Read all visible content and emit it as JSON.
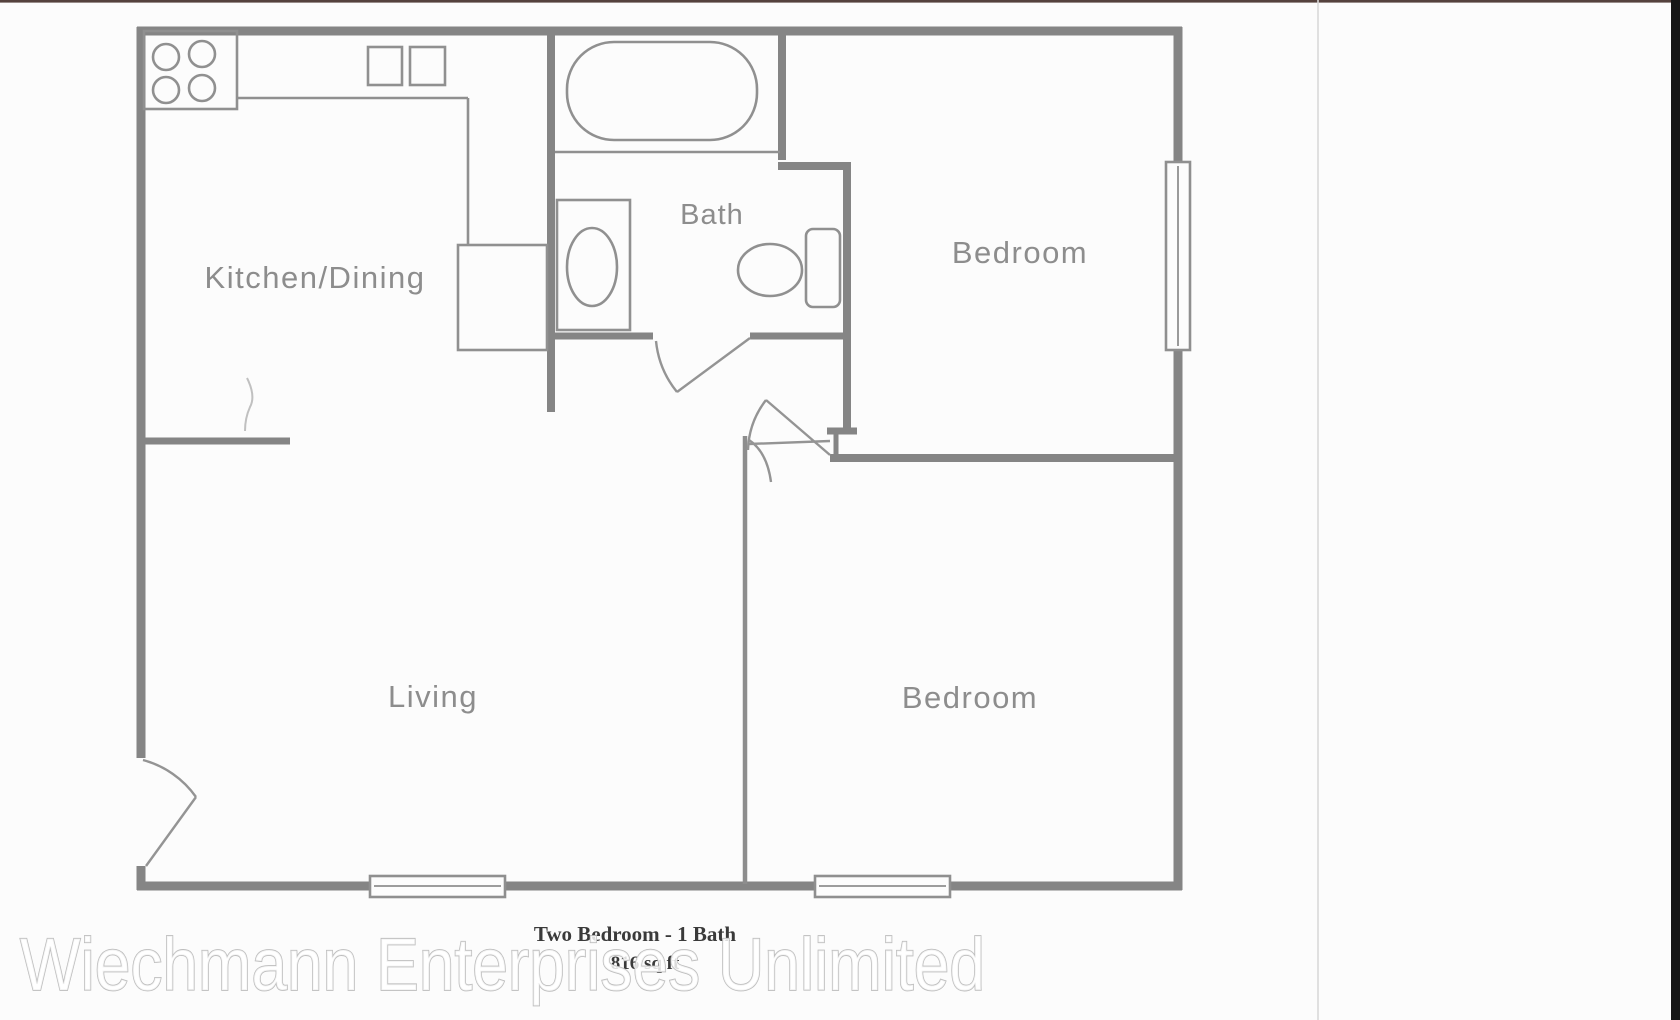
{
  "photo": {
    "caption_title": "Two Bedroom - 1 Bath",
    "caption_subtitle": "816 sq ft",
    "watermark": "Wiechmann Enterprises Unlimited"
  },
  "floor_plan": {
    "rooms": {
      "kitchen_dining": "Kitchen/Dining",
      "bath": "Bath",
      "bedroom_top": "Bedroom",
      "living": "Living",
      "bedroom_bottom": "Bedroom"
    },
    "colors": {
      "wall_line": "#858585",
      "fixture_line": "#909090",
      "door_line": "#949494",
      "room_label": "#8d8d8d",
      "caption_text": "#3a3a3a",
      "watermark_fill": "#ffffff",
      "watermark_outline": "#bdbdbd",
      "top_border": "#55423d",
      "right_edge_bar": "#171717",
      "scan_divider": "#d9d9d9",
      "paper": "#fcfcfc"
    }
  }
}
